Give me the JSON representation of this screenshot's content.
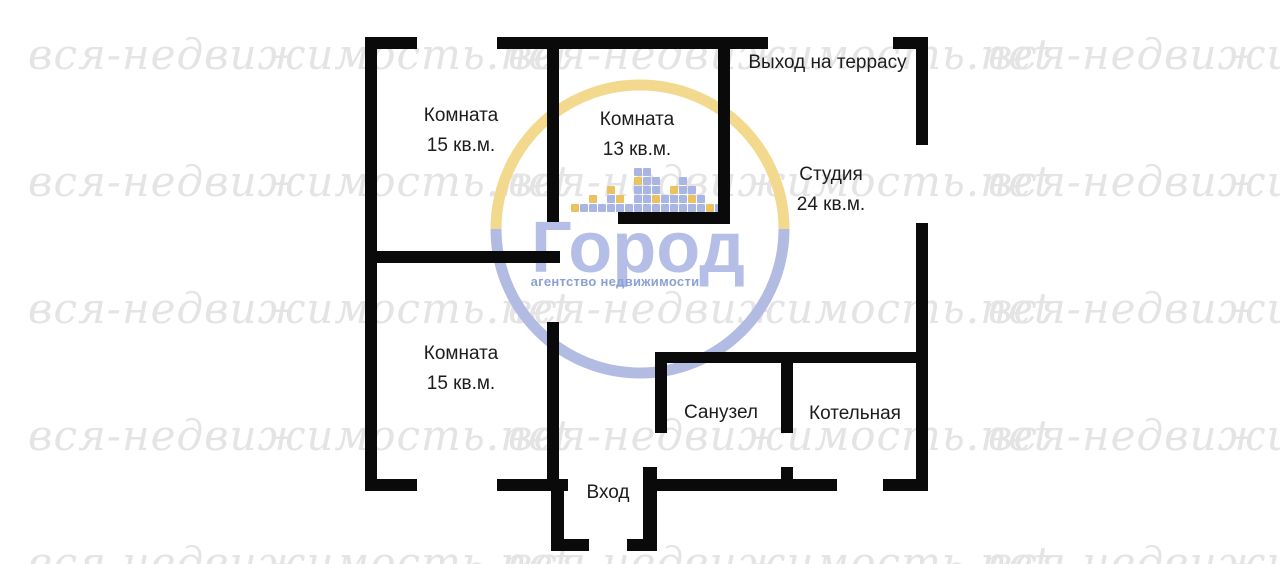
{
  "plan": {
    "wall_color": "#0a0a0a",
    "rooms": [
      {
        "id": "room-top-left",
        "name": "Комната",
        "area": "15 кв.м."
      },
      {
        "id": "room-top-middle",
        "name": "Комната",
        "area": "13 кв.м."
      },
      {
        "id": "studio",
        "name": "Студия",
        "area": "24 кв.м."
      },
      {
        "id": "room-bottom-left",
        "name": "Комната",
        "area": "15 кв.м."
      },
      {
        "id": "bathroom",
        "name": "Санузел"
      },
      {
        "id": "boiler-room",
        "name": "Котельная"
      }
    ],
    "annotations": {
      "terrace_exit": "Выход на террасу",
      "entrance": "Вход"
    }
  },
  "watermark": {
    "text": "вся-недвижимость.net",
    "color": "#e4e4e4"
  },
  "logo": {
    "brand": "Город",
    "tagline": "агентство недвижимости",
    "colors": {
      "ring_top": "#f2d98e",
      "ring_bottom": "#b2bce3",
      "brand_text": "#b4bee6",
      "tagline_text": "#8ca0d6",
      "pixel_blue": "#a9b5e2",
      "pixel_yellow": "#eac25f"
    },
    "skyline": [
      [
        "y"
      ],
      [
        "b"
      ],
      [
        "b",
        "y"
      ],
      [
        "b"
      ],
      [
        "b",
        "b",
        "y"
      ],
      [
        "b",
        "y"
      ],
      [
        "b"
      ],
      [
        "b",
        "b",
        "b",
        "y",
        "b"
      ],
      [
        "b",
        "b",
        "b",
        "b",
        "b"
      ],
      [
        "b",
        "y",
        "b",
        "b"
      ],
      [
        "b",
        "b"
      ],
      [
        "b",
        "b",
        "y"
      ],
      [
        "b",
        "b",
        "b",
        "b"
      ],
      [
        "b",
        "y",
        "b"
      ],
      [
        "b",
        "b"
      ],
      [
        "y"
      ],
      [
        "b"
      ]
    ]
  }
}
